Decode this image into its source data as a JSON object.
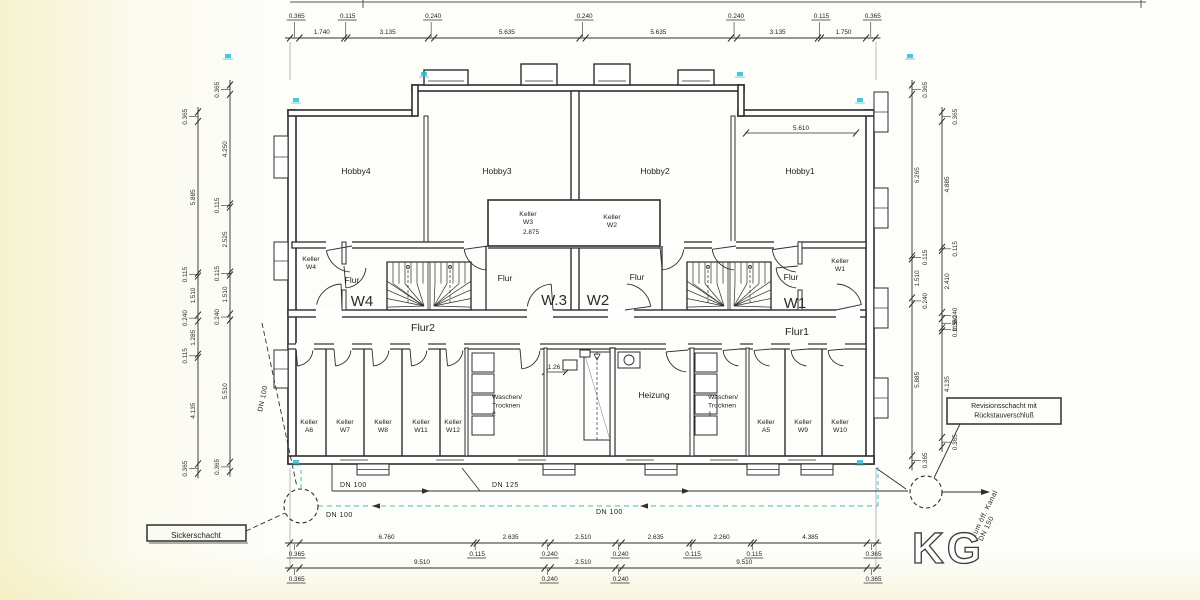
{
  "plan": {
    "floor_label": "KG",
    "rooms": {
      "hobby4": "Hobby4",
      "hobby3": "Hobby3",
      "hobby2": "Hobby2",
      "hobby1": "Hobby1",
      "flur_left": "Flur",
      "flur_center_left": "Flur",
      "flur_center_right": "Flur",
      "flur_right": "Flur",
      "flur2": "Flur2",
      "flur1": "Flur1",
      "unit_w4": "W4",
      "unit_w3": "W.3",
      "unit_w2": "W2",
      "unit_w1": "W1",
      "heizung": "Heizung"
    },
    "small_rooms": {
      "keller_w4": [
        "Keller",
        "W4"
      ],
      "keller_w3": [
        "Keller",
        "W3"
      ],
      "keller_w2": [
        "Keller",
        "W2"
      ],
      "keller_w1": [
        "Keller",
        "W1"
      ]
    },
    "bottom_rooms_left": [
      [
        "Keller",
        "A6"
      ],
      [
        "Keller",
        "W7"
      ],
      [
        "Keller",
        "W8"
      ],
      [
        "Keller",
        "W11"
      ],
      [
        "Keller",
        "W12"
      ]
    ],
    "bottom_rooms_right": [
      [
        "Keller",
        "A5"
      ],
      [
        "Keller",
        "W9"
      ],
      [
        "Keller",
        "W10"
      ]
    ],
    "wash_left": [
      "Waschen/",
      "Trocknen",
      "2"
    ],
    "wash_right": [
      "Waschen/",
      "Trocknen",
      "1"
    ],
    "dims": {
      "top": [
        "0.365",
        "1.740",
        "0.115",
        "3.135",
        "0.240",
        "5.635",
        "0.240",
        "5.635",
        "0.240",
        "3.135",
        "0.115",
        "1.750",
        "0.365"
      ],
      "bottom1": [
        "0.365",
        "6.760",
        "0.115",
        "2.635",
        "0.240",
        "2.510",
        "0.240",
        "2.635",
        "0.115",
        "2.260",
        "0.115",
        "4.385",
        "0.365"
      ],
      "bottom2": [
        "0.365",
        "9.510",
        "0.240",
        "2.510",
        "0.240",
        "9.510",
        "0.365"
      ],
      "left_outer": [
        "0.365",
        "5.885",
        "0.115",
        "1.510",
        "0.240",
        "1.285",
        "0.115",
        "4.135",
        "0.365"
      ],
      "left_inner": [
        "0.365",
        "4.250",
        "0.115",
        "2.525",
        "0.115",
        "1.510",
        "0.240",
        "5.510",
        "0.365"
      ],
      "right_outer": [
        "0.365",
        "6.265",
        "0.115",
        "1.510",
        "0.240",
        "5.885",
        "0.365"
      ],
      "right_inner": [
        "0.365",
        "4.885",
        "0.115",
        "2.410",
        "0.240",
        "0.360",
        "0.115",
        "4.135",
        "0.365"
      ],
      "hobby1_width": "5.610",
      "keller_w3_width": "2.875",
      "shaft_width": "1.26"
    },
    "pipes": {
      "dn100_a": "DN 100",
      "dn125": "DN 125",
      "dn100_b": "DN 100",
      "dn100_c": "DN 100",
      "dn100_d": "DN 100",
      "outfall": [
        "zum öff. Kanal",
        "DN 150"
      ]
    },
    "annotations": {
      "sickerschacht": "Sickerschacht",
      "revision": [
        "Revisionsschacht mit",
        "Rückstauverschluß"
      ]
    },
    "colors": {
      "line": "#2e2e2e",
      "pipe_teal": "#4ab6c8",
      "mark_cyan": "#2fb9d4"
    }
  }
}
